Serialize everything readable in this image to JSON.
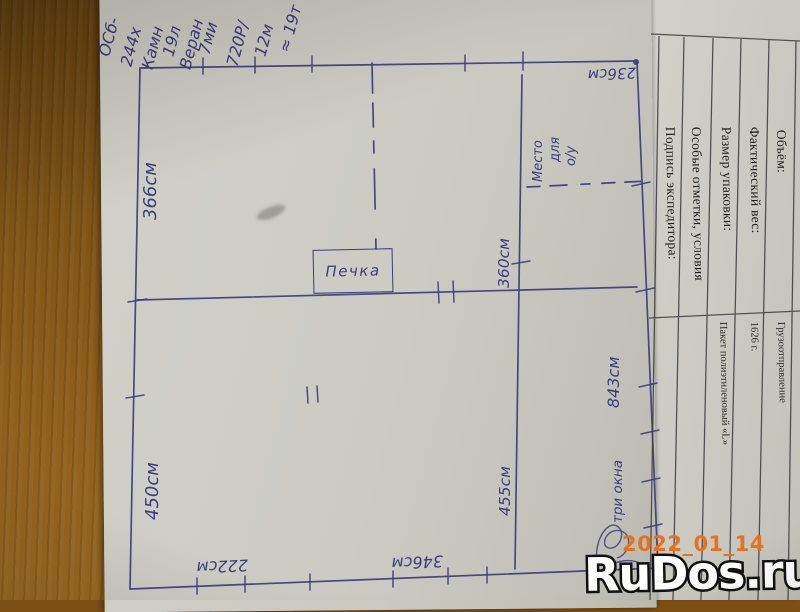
{
  "plan": {
    "stove": "Печка",
    "dim_top_left": "366см",
    "dim_bottom_left": "450см",
    "dim_top_right": "360см",
    "dim_bottom_right": "455см",
    "dim_right_total": "843см",
    "dim_top_right_width": "236см",
    "dim_bottom_left_width": "222см",
    "dim_bottom_mid_width": "346см",
    "note_place_line1": "Место",
    "note_place_line2": "для",
    "note_place_line3": "о/у",
    "note_windows": "три окна",
    "ink_color": "#3d3d7a"
  },
  "top_notes": [
    "ОСб-",
    "244х",
    "Камн",
    "19л",
    "Веран",
    "7ми",
    "720Р/",
    "12м",
    "≈ 19т"
  ],
  "form": {
    "headers": [
      "Объём:",
      "Фактический вес:",
      "Размер упаковки:",
      "Особые отметки, условия",
      "Подпись экспедитора:"
    ],
    "values": [
      "Грузоотправление",
      "1626 г.",
      "Пакет полиэтиленовый «L»"
    ]
  },
  "watermark": {
    "date": "2022_01_14",
    "site": "RuDos.ru",
    "date_color": "#e8721c"
  }
}
